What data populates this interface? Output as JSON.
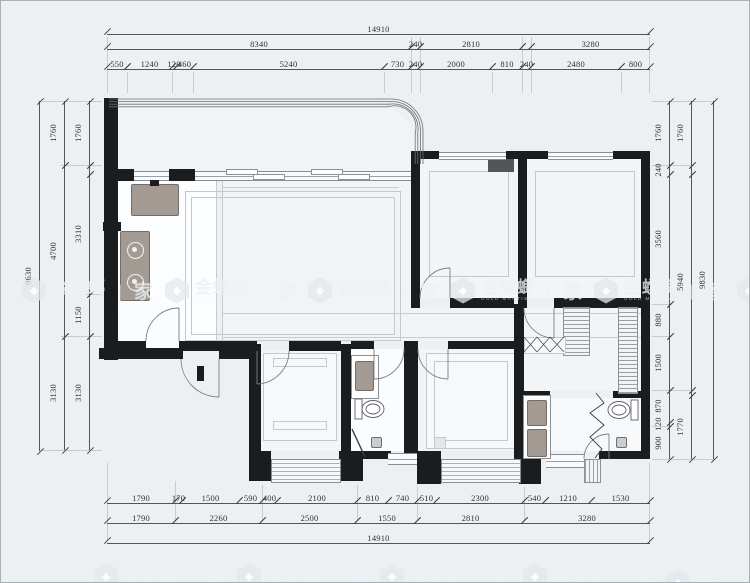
{
  "watermark": {
    "brand": "金螳螂",
    "caption": "GOLD MANTIS",
    "divider": "丨",
    "home": "家",
    "icon_glyph": "◆"
  },
  "dims": {
    "top_total": "14910",
    "top_row2": [
      "8340",
      "240",
      "2810",
      "",
      "3280"
    ],
    "top_row3": [
      "550",
      "1240",
      "120",
      "460",
      "5240",
      "730",
      "240",
      "2000",
      "810",
      "240",
      "2480",
      "800"
    ],
    "bottom_row1": [
      "1790",
      "170",
      "1500",
      "590",
      "400",
      "2100",
      "810",
      "740",
      "510",
      "2300",
      "540",
      "1210",
      "1530"
    ],
    "bottom_row2": [
      "1790",
      "2260",
      "2500",
      "1550",
      "2810",
      "3280"
    ],
    "bottom_total": "14910",
    "left_total": "9630",
    "left_mid": [
      "1760",
      "4700",
      "3130"
    ],
    "left_inner": [
      "1760",
      "3310",
      "1150",
      "3130"
    ],
    "right_inner": [
      "1760",
      "240",
      "3560",
      "880",
      "1500",
      "870",
      "120",
      "900"
    ],
    "right_mid": [
      "1760",
      "5940",
      "1770"
    ],
    "right_total": "9830"
  }
}
